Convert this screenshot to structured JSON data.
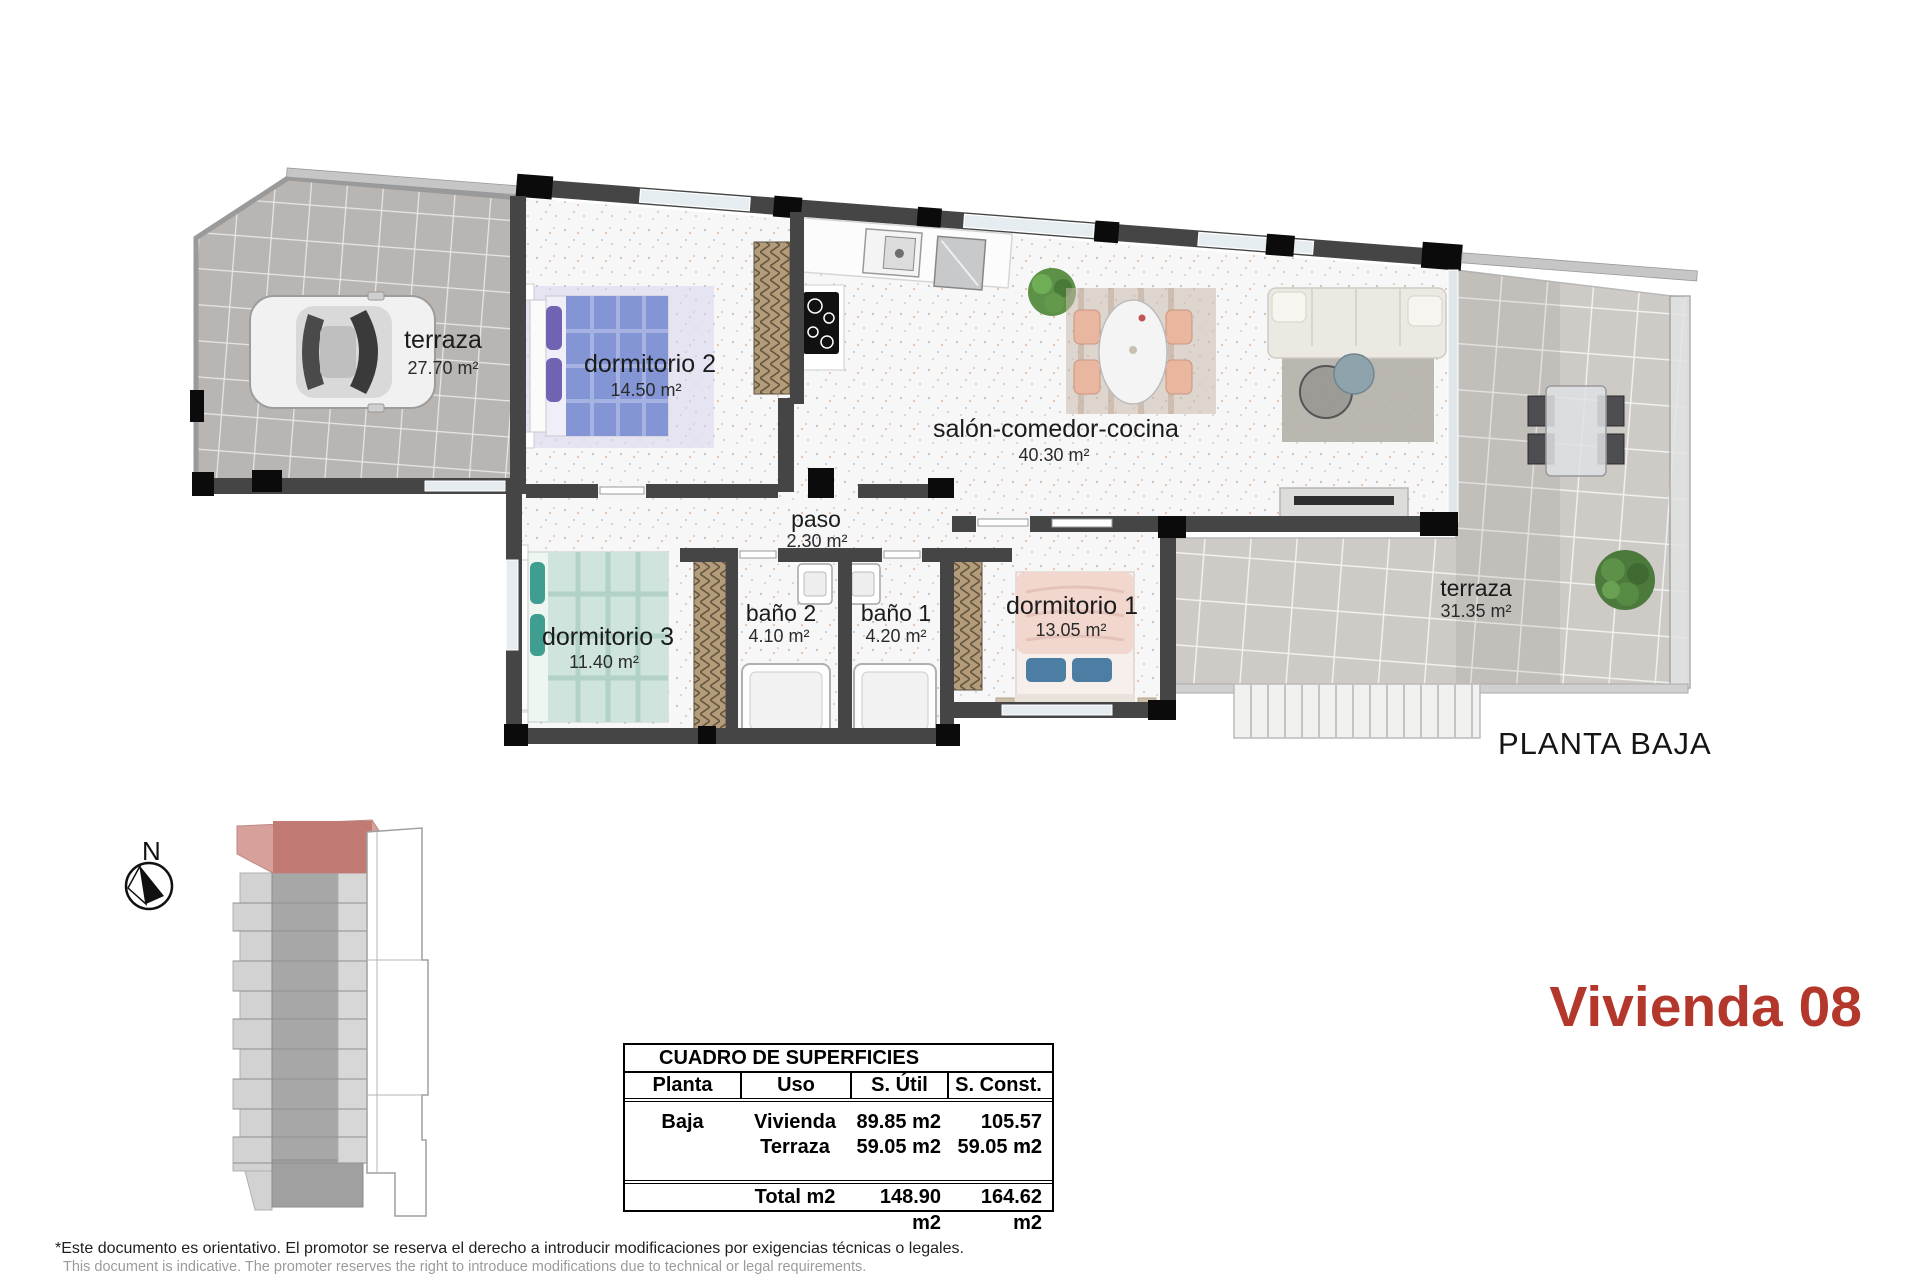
{
  "title": "Vivienda 08",
  "plan": {
    "floor_label": "PLANTA BAJA",
    "rooms": [
      {
        "id": "terraza-garaje",
        "name": "terraza",
        "area": "27.70 m²"
      },
      {
        "id": "dormitorio-2",
        "name": "dormitorio 2",
        "area": "14.50 m²"
      },
      {
        "id": "salon-comedor-cocina",
        "name": "salón-comedor-cocina",
        "area": "40.30 m²"
      },
      {
        "id": "paso",
        "name": "paso",
        "area": "2.30 m²"
      },
      {
        "id": "dormitorio-3",
        "name": "dormitorio 3",
        "area": "11.40 m²"
      },
      {
        "id": "bano-2",
        "name": "baño 2",
        "area": "4.10 m²"
      },
      {
        "id": "bano-1",
        "name": "baño 1",
        "area": "4.20 m²"
      },
      {
        "id": "dormitorio-1",
        "name": "dormitorio 1",
        "area": "13.05 m²"
      },
      {
        "id": "terraza",
        "name": "terraza",
        "area": "31.35 m²"
      }
    ]
  },
  "compass": {
    "north_label": "N"
  },
  "surfaces_table": {
    "title": "CUADRO DE SUPERFICIES",
    "headers": [
      "Planta",
      "Uso",
      "S. Útil",
      "S. Const."
    ],
    "rows": [
      {
        "planta": "Baja",
        "uso": "Vivienda",
        "util": "89.85 m2",
        "const": "105.57 m2"
      },
      {
        "planta": "",
        "uso": "Terraza",
        "util": "59.05 m2",
        "const": "59.05 m2"
      }
    ],
    "total": {
      "label": "Total m2",
      "util": "148.90 m2",
      "const": "164.62 m2"
    }
  },
  "footer": {
    "line1": "*Este documento es orientativo. El promotor se reserva el derecho a introducir modificaciones por exigencias técnicas o legales.",
    "line2": "This document is indicative. The promoter reserves the right to introduce modifications due to technical or legal requirements."
  },
  "colors": {
    "accent_red": "#b4372c",
    "site_plan_red": "#c17b74",
    "site_plan_pink": "#d8a09b",
    "wall_dark": "#454545",
    "column_black": "#0b0b0b",
    "tile_gray": "#b8b5b2",
    "terrace_tile": "#cecbc7",
    "window_glass": "#e6edf0"
  }
}
